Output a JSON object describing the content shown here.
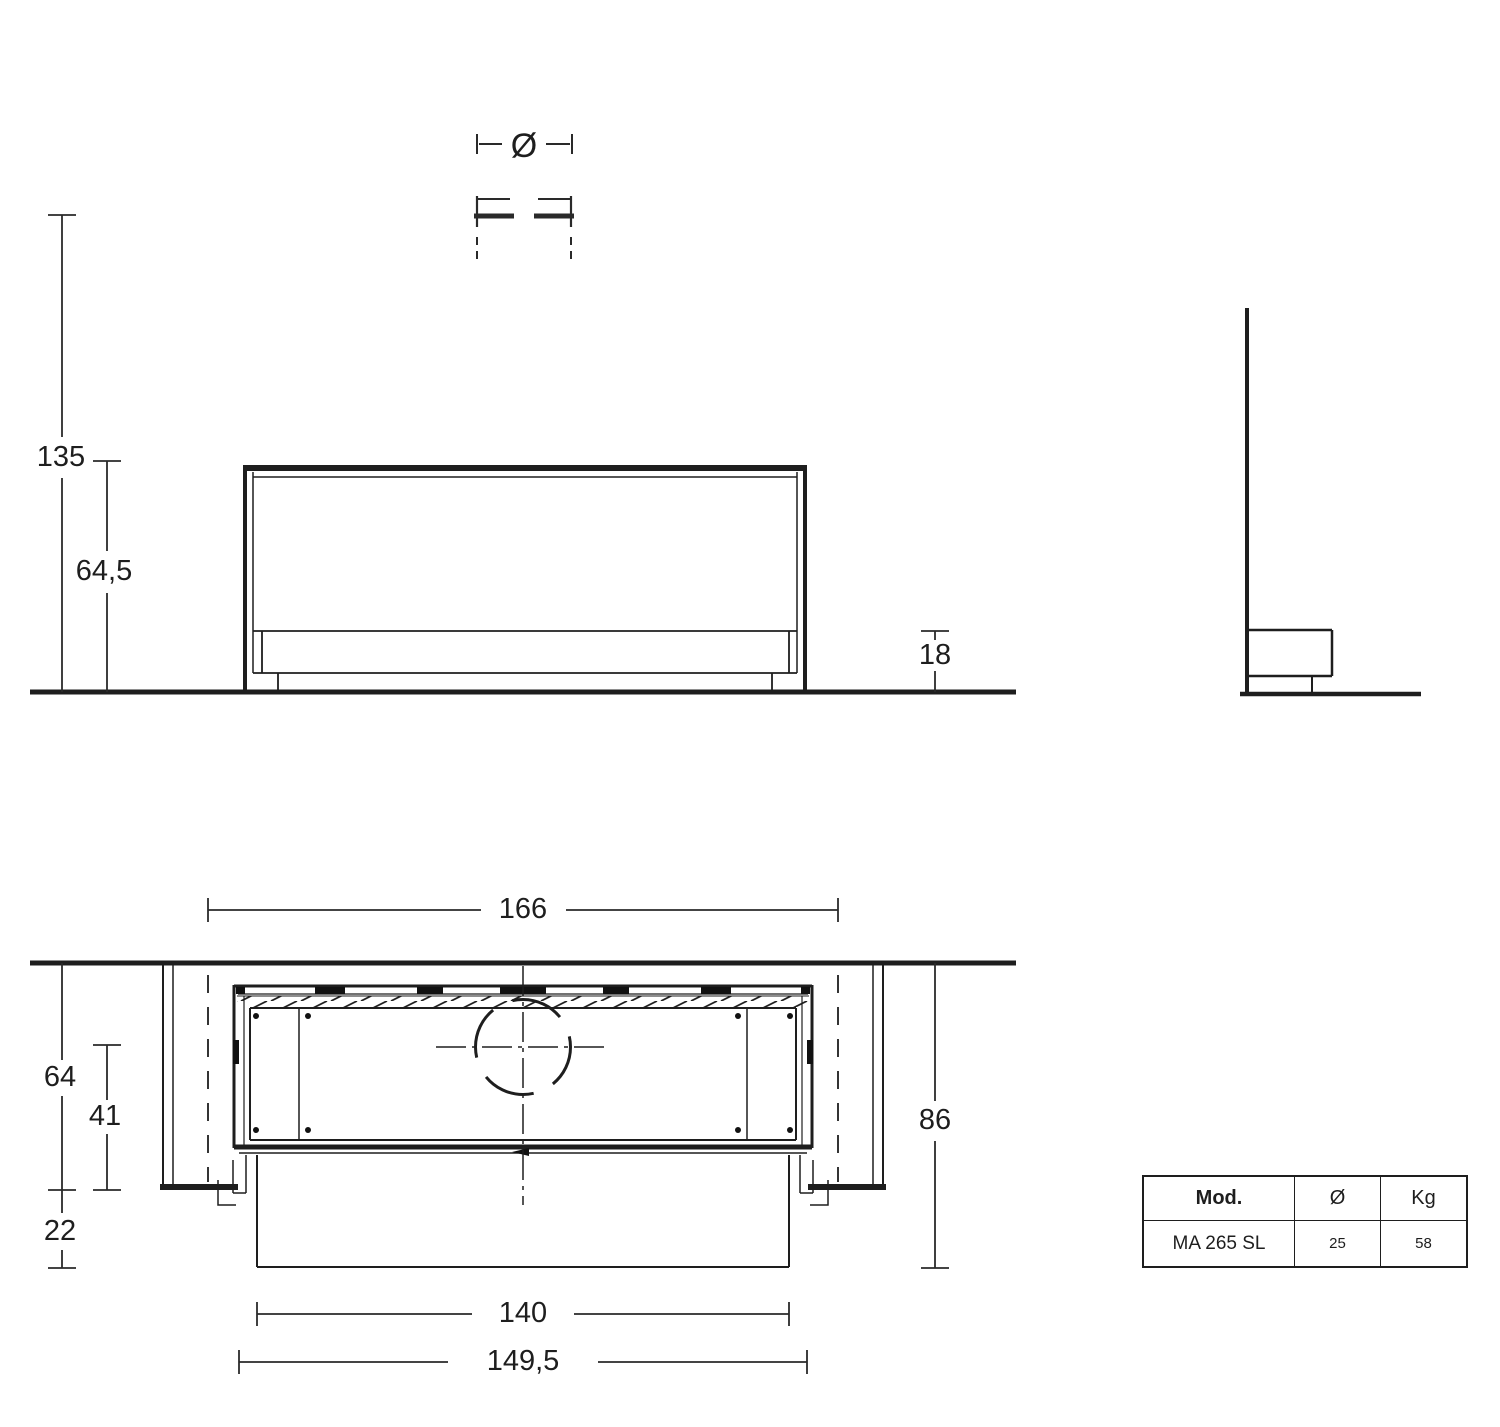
{
  "symbols": {
    "diameter": "Ø"
  },
  "dimensions": {
    "total_height": "135",
    "firebox_height": "64,5",
    "plinth_height": "18",
    "overall_width": "166",
    "niche_depth": "64",
    "firebox_depth": "41",
    "front_projection": "22",
    "overall_depth": "86",
    "front_width": "140",
    "base_width": "149,5"
  },
  "spec_table": {
    "headers": [
      "Mod.",
      "Ø",
      "Kg"
    ],
    "rows": [
      [
        "MA 265 SL",
        "25",
        "58"
      ]
    ]
  }
}
